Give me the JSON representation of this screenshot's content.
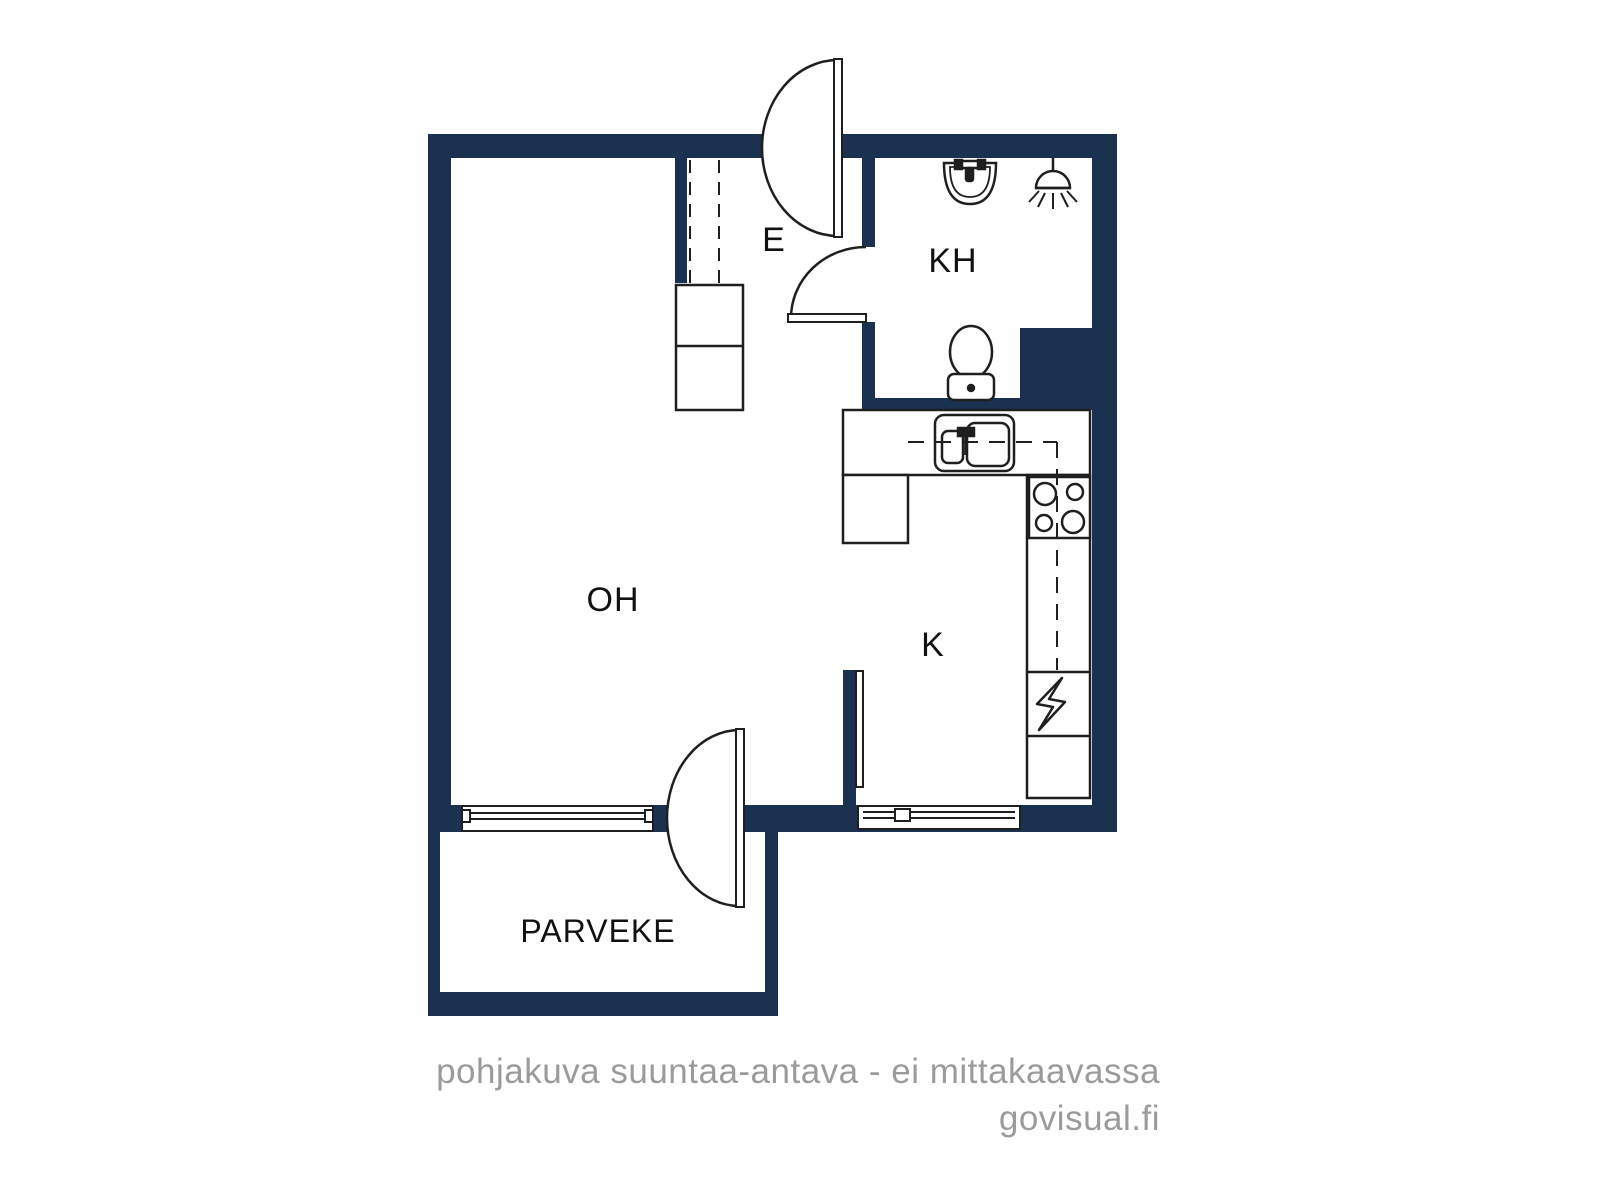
{
  "colors": {
    "background": "#ffffff",
    "wall": "#1a3150",
    "line": "#1f1f1f",
    "label": "#111111",
    "footer": "#9b9b9b"
  },
  "floorplan": {
    "type": "apartment-floor-plan",
    "rooms": {
      "living_room": {
        "label": "OH"
      },
      "entry": {
        "label": "E"
      },
      "bathroom": {
        "label": "KH"
      },
      "kitchen": {
        "label": "K"
      },
      "balcony": {
        "label": "PARVEKE"
      }
    },
    "fixtures": [
      "entry-door",
      "bathroom-door",
      "balcony-door",
      "interior-door-leaf",
      "wardrobe-dashed",
      "hall-cabinet",
      "bathroom-sink",
      "shower-head",
      "toilet",
      "kitchen-sink",
      "stove-4-burners",
      "appliance-lightning",
      "kitchen-counters",
      "window-living-room",
      "window-kitchen"
    ]
  },
  "footer": {
    "disclaimer": "pohjakuva suuntaa-antava - ei mittakaavassa",
    "brand": "govisual.fi"
  }
}
